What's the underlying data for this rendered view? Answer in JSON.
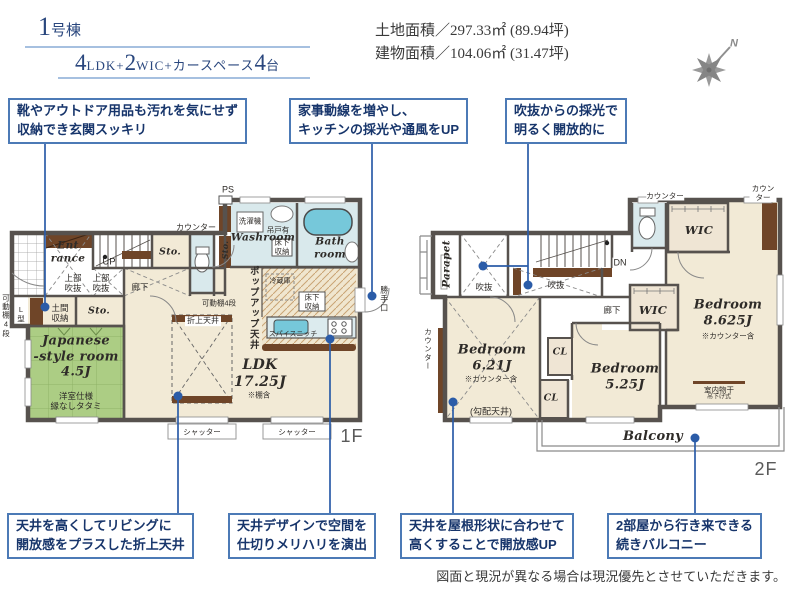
{
  "header": {
    "unit_number": "1",
    "unit_suffix": "号棟",
    "spec": {
      "n1": "4",
      "s1": "LDK+",
      "n2": "2",
      "s2": "WIC+カースペース",
      "n3": "4",
      "s3": "台"
    },
    "land_area": "土地面積／297.33㎡ (89.94坪)",
    "building_area": "建物面積／104.06㎡ (31.47坪)",
    "compass_north": "N"
  },
  "callouts_top": [
    {
      "text": "靴やアウトドア用品も汚れを気にせず\n収納でき玄関スッキリ"
    },
    {
      "text": "家事動線を増やし、\nキッチンの採光や通風をUP"
    },
    {
      "text": "吹抜からの採光で\n明るく開放的に"
    }
  ],
  "callouts_bottom": [
    {
      "text": "天井を高くしてリビングに\n開放感をプラスした折上天井"
    },
    {
      "text": "天井デザインで空間を\n仕切りメリハリを演出"
    },
    {
      "text": "天井を屋根形状に合わせて\n高くすることで開放感UP"
    },
    {
      "text": "2部屋から行き来できる\n続きバルコニー"
    }
  ],
  "floor1": {
    "floor_label": "1F",
    "ps": "PS",
    "counter_top": "カウンター",
    "washer": "洗濯機",
    "hanging_cabinet": "吊戸有",
    "washroom": "Washroom",
    "underfloor_storage_wash": "床下\n収納",
    "bathroom": "Bath\nroom",
    "sto_vertical": "Sto.",
    "sto_top": "Sto.",
    "entrance": "Ent\nrance",
    "up": "UP",
    "void_upper1": "上部\n吹抜",
    "void_upper2": "上部\n吹抜",
    "hallway": "廊下",
    "shelf_mid": "可動棚4段",
    "shelf_left": "可動棚4段",
    "l_type": "L型",
    "doma_storage": "土間\n収納",
    "sto2": "Sto.",
    "japanese_room": "Japanese\n-style room\n4.5J",
    "japanese_note": "洋室仕様\n縁なしタタミ",
    "popup_ceiling": "ポップアップ天井",
    "fridge": "冷蔵庫",
    "underfloor_storage_kitchen": "床下\n収納",
    "spice_niche": "スパイスニッチ",
    "coffered_ceiling": "折上天井",
    "ldk": "LDK\n17.25J",
    "ldk_note": "※棚含",
    "back_door": "勝手口",
    "shutter1": "シャッター",
    "shutter2": "シャッター"
  },
  "floor2": {
    "floor_label": "2F",
    "parapet": "Parapet",
    "void1": "吹抜",
    "void2": "吹抜",
    "dn": "DN",
    "counter1": "カウンター",
    "counter2": "カウンター",
    "counter_left": "カウンター",
    "wic1": "WIC",
    "wic2": "WIC",
    "hallway": "廊下",
    "bedroom1": "Bedroom\n8.625J",
    "bedroom1_note": "※カウンター含",
    "bedroom2": "Bedroom\n6.21J",
    "bedroom2_note": "※カウンター含",
    "sloped_ceiling": "(勾配天井)",
    "cl1": "CL",
    "cl2": "CL",
    "bedroom3": "Bedroom\n5.25J",
    "indoor_drying": "室内物干",
    "indoor_drying_sub": "吊下げ式",
    "balcony": "Balcony"
  },
  "disclaimer": "図面と現況が異なる場合は現況優先とさせていただきます。",
  "colors": {
    "wall": "#57524e",
    "floor": "#f2ead6",
    "tatami": "#accd84",
    "wet": "#d9e9ec",
    "tub": "#76c8da",
    "wood": "#6f4528",
    "leader": "#2b5ca8",
    "callout_border": "#4c7ab6",
    "callout_text": "#17356b",
    "header_navy": "#2a477e"
  }
}
